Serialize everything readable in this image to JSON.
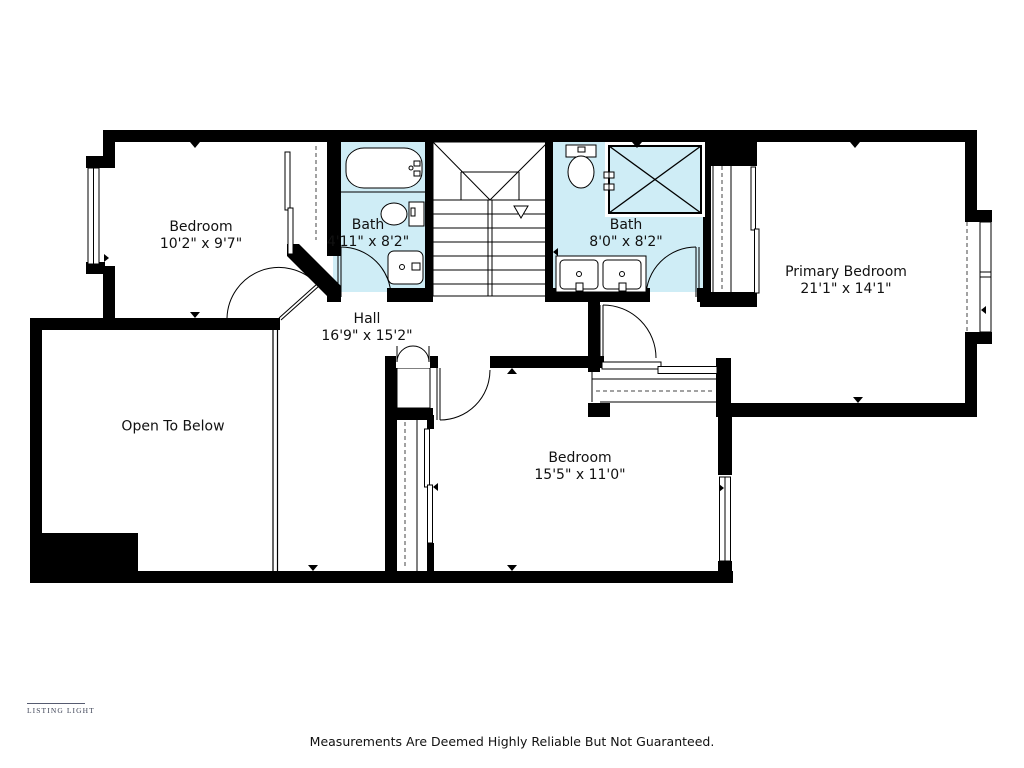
{
  "rooms": {
    "bedroom1": {
      "name": "Bedroom",
      "dims": "10'2\" x 9'7\""
    },
    "bath1": {
      "name": "Bath",
      "dims": "4'11\" x 8'2\""
    },
    "hall": {
      "name": "Hall",
      "dims": "16'9\" x 15'2\""
    },
    "bath2": {
      "name": "Bath",
      "dims": "8'0\" x 8'2\""
    },
    "primary": {
      "name": "Primary Bedroom",
      "dims": "21'1\" x 14'1\""
    },
    "open_below": {
      "name": "Open To Below"
    },
    "bedroom2": {
      "name": "Bedroom",
      "dims": "15'5\" x 11'0\""
    }
  },
  "branding": {
    "logo_text": "LISTING LIGHT"
  },
  "footer": {
    "disclaimer": "Measurements Are Deemed Highly Reliable But Not Guaranteed."
  },
  "colors": {
    "bath_fill": "#CFEDF6",
    "wall": "#000000",
    "logo": "#3D4356"
  }
}
